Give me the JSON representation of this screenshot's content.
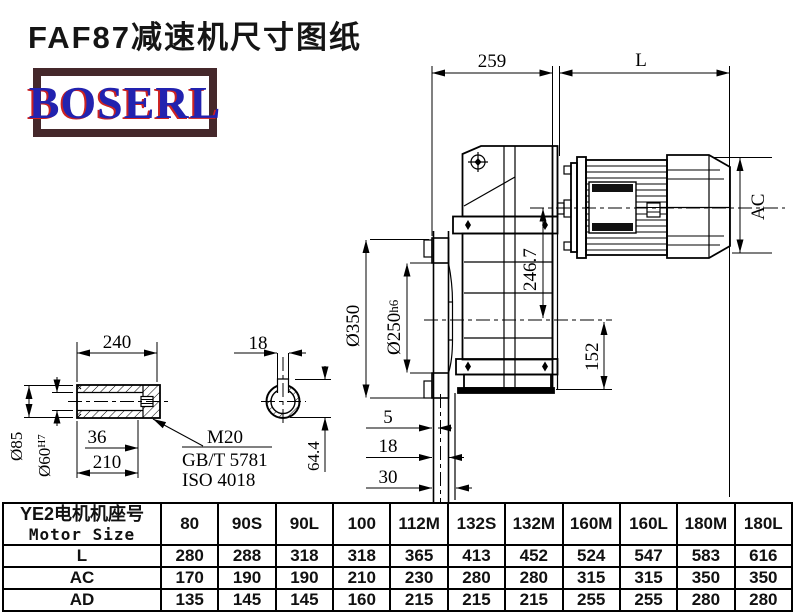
{
  "title": "FAF87减速机尺寸图纸",
  "logo": {
    "text": "BOSERL",
    "border_color": "#45282b",
    "text_color": "#2222af",
    "shadow_color": "#cc2222"
  },
  "drawing": {
    "dims": {
      "d259": "259",
      "L": "L",
      "AC": "AC",
      "d246_7": "246.7",
      "d152": "152",
      "dia350": "Ø350",
      "dia250": "Ø250",
      "dia250_tol": "h6",
      "d5": "5",
      "d18": "18",
      "d30": "30",
      "d240": "240",
      "dia85": "Ø85",
      "dia60": "Ø60",
      "dia60_tol": "H7",
      "d36": "36",
      "d210": "210",
      "m20": "M20",
      "gbt": "GB/T 5781",
      "iso": "ISO 4018",
      "d18_key": "18",
      "d64_4": "64.4"
    }
  },
  "table": {
    "header_cn": "YE2电机机座号",
    "header_en": "Motor Size",
    "columns": [
      "80",
      "90S",
      "90L",
      "100",
      "112M",
      "132S",
      "132M",
      "160M",
      "160L",
      "180M",
      "180L"
    ],
    "rows": [
      {
        "label": "L",
        "values": [
          "280",
          "288",
          "318",
          "318",
          "365",
          "413",
          "452",
          "524",
          "547",
          "583",
          "616"
        ]
      },
      {
        "label": "AC",
        "values": [
          "170",
          "190",
          "190",
          "210",
          "230",
          "280",
          "280",
          "315",
          "315",
          "350",
          "350"
        ]
      },
      {
        "label": "AD",
        "values": [
          "135",
          "145",
          "145",
          "160",
          "215",
          "215",
          "215",
          "255",
          "255",
          "280",
          "280"
        ]
      }
    ]
  }
}
